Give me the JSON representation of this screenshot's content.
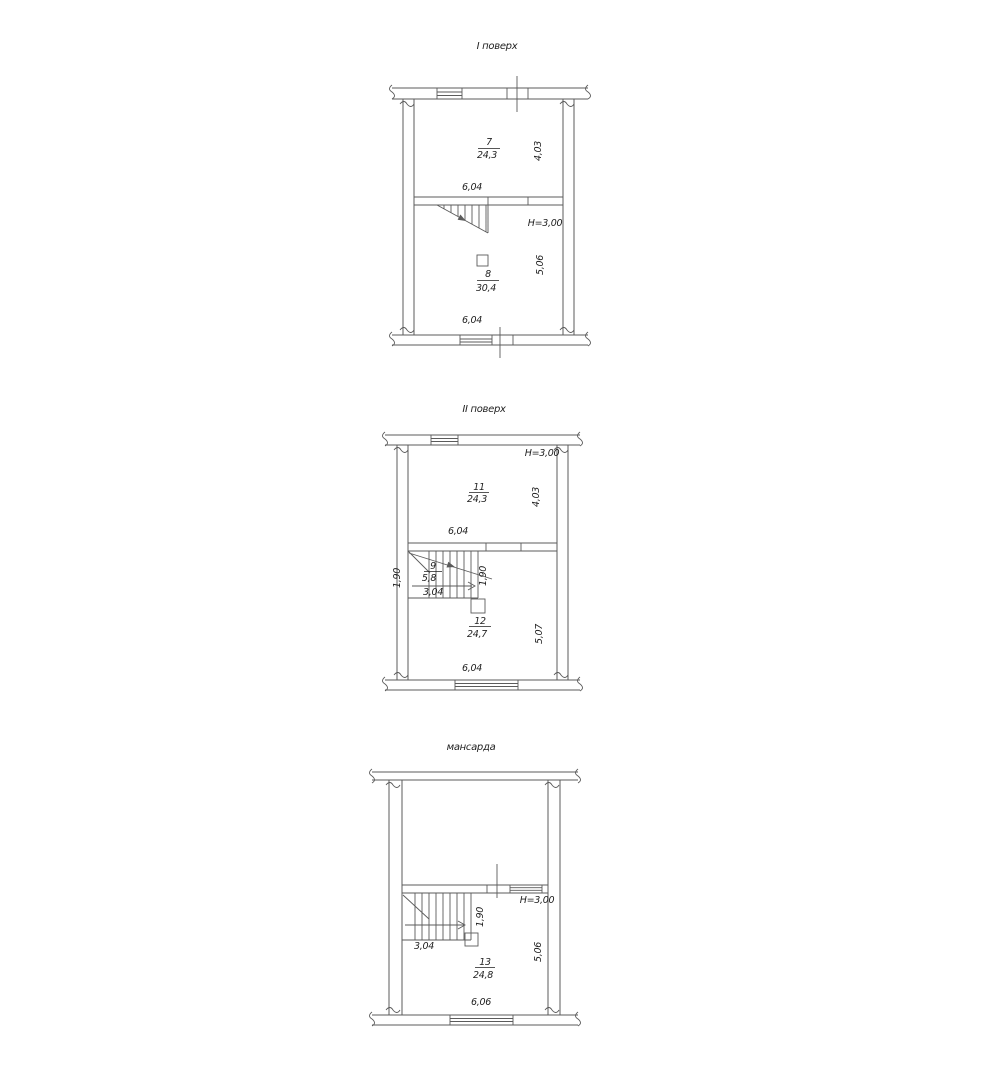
{
  "colors": {
    "background": "#ffffff",
    "line": "#5b5b5b",
    "text": "#1f1f1f"
  },
  "plans": [
    {
      "title": "I поверх",
      "height_label": "H=3,00",
      "rooms": [
        {
          "number": "7",
          "area": "24,3",
          "width": "6,04",
          "depth": "4,03"
        },
        {
          "number": "8",
          "area": "30,4",
          "width": "6,04",
          "depth": "5,06"
        }
      ]
    },
    {
      "title": "II поверх",
      "height_label": "H=3,00",
      "rooms": [
        {
          "number": "11",
          "area": "24,3",
          "width": "6,04",
          "depth": "4,03"
        },
        {
          "number": "9",
          "area": "5,8",
          "width": "3,04",
          "left": "1,90",
          "right": "1,90"
        },
        {
          "number": "12",
          "area": "24,7",
          "width": "6,04",
          "depth": "5,07"
        }
      ]
    },
    {
      "title": "мансарда",
      "height_label": "H=3,00",
      "stair": {
        "width": "3,04",
        "depth": "1,90"
      },
      "rooms": [
        {
          "number": "13",
          "area": "24,8",
          "width": "6,06",
          "depth": "5,06"
        }
      ]
    }
  ]
}
